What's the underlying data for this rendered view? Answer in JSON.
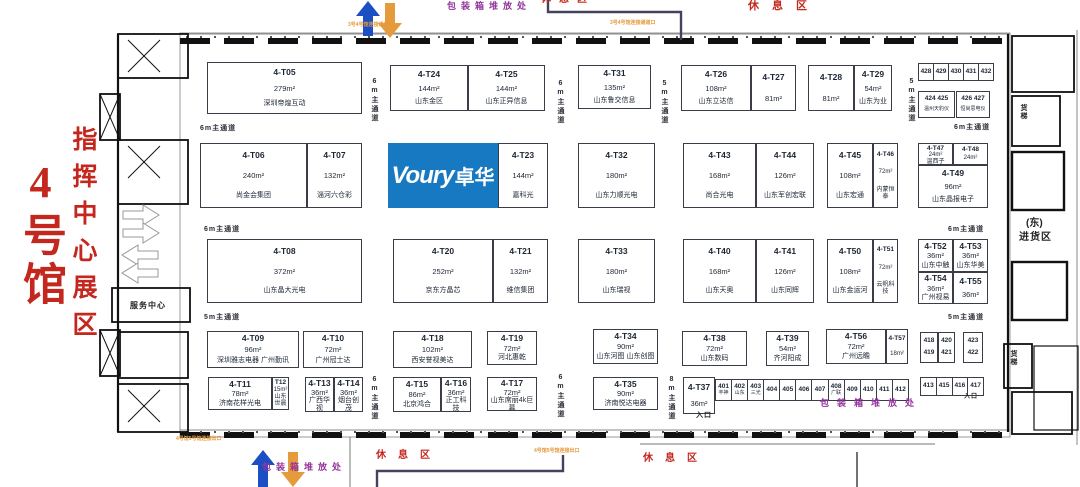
{
  "left": {
    "hall": "4号馆",
    "zone": "指挥中心展区",
    "service_center": "服务中心"
  },
  "logo": {
    "en": "Voury",
    "cn": "卓华"
  },
  "colors": {
    "red": "#c4271d",
    "orange": "#e59a3c",
    "blue": "#1d4fc4",
    "purple": "#94359c",
    "navy": "#43435f",
    "logo_blue": "#1779c1"
  },
  "booths": [
    {
      "id": "4-T05",
      "area": "279m²",
      "name": "深圳帝煌互动",
      "x": 207,
      "y": 62,
      "w": 155,
      "h": 52
    },
    {
      "id": "4-T24",
      "area": "144m²",
      "name": "山东金区",
      "x": 390,
      "y": 65,
      "w": 78,
      "h": 46
    },
    {
      "id": "4-T25",
      "area": "144m²",
      "name": "山东正异信息",
      "x": 468,
      "y": 65,
      "w": 77,
      "h": 46
    },
    {
      "id": "4-T31",
      "area": "135m²",
      "name": "山东鲁交信息",
      "x": 578,
      "y": 65,
      "w": 73,
      "h": 44
    },
    {
      "id": "4-T26",
      "area": "108m²",
      "name": "山东立达信",
      "x": 681,
      "y": 65,
      "w": 70,
      "h": 46
    },
    {
      "id": "4-T27",
      "area": "81m²",
      "name": "",
      "x": 751,
      "y": 65,
      "w": 45,
      "h": 46
    },
    {
      "id": "4-T28",
      "area": "81m²",
      "name": "",
      "x": 808,
      "y": 65,
      "w": 46,
      "h": 46
    },
    {
      "id": "4-T29",
      "area": "54m²",
      "name": "山东为业",
      "x": 854,
      "y": 65,
      "w": 38,
      "h": 46
    },
    {
      "id": "4-T06",
      "area": "240m²",
      "name": "尚金会集团",
      "x": 200,
      "y": 143,
      "w": 107,
      "h": 65
    },
    {
      "id": "4-T07",
      "area": "132m²",
      "name": "淄河六仓彩",
      "x": 307,
      "y": 143,
      "w": 55,
      "h": 65
    },
    {
      "id": "4-T23",
      "area": "144m²",
      "name": "嘉科光",
      "x": 498,
      "y": 143,
      "w": 50,
      "h": 65
    },
    {
      "id": "4-T32",
      "area": "180m²",
      "name": "山东力顺光电",
      "x": 578,
      "y": 143,
      "w": 77,
      "h": 65
    },
    {
      "id": "4-T43",
      "area": "168m²",
      "name": "尚合光电",
      "x": 683,
      "y": 143,
      "w": 73,
      "h": 65
    },
    {
      "id": "4-T44",
      "area": "126m²",
      "name": "山东军创宏联",
      "x": 756,
      "y": 143,
      "w": 58,
      "h": 65
    },
    {
      "id": "4-T45",
      "area": "108m²",
      "name": "山东宏通",
      "x": 827,
      "y": 143,
      "w": 46,
      "h": 65
    },
    {
      "id": "4-T46",
      "area": "72m²",
      "name": "内蒙恒泰",
      "x": 873,
      "y": 143,
      "w": 25,
      "h": 65
    },
    {
      "id": "4-T47",
      "area": "24m²",
      "name": "温西子",
      "x": 918,
      "y": 143,
      "w": 35,
      "h": 22
    },
    {
      "id": "4-T48",
      "area": "24m²",
      "name": "",
      "x": 953,
      "y": 143,
      "w": 35,
      "h": 22
    },
    {
      "id": "4-T49",
      "area": "96m²",
      "name": "山东晶报电子",
      "x": 918,
      "y": 165,
      "w": 70,
      "h": 43
    },
    {
      "id": "4-T08",
      "area": "372m²",
      "name": "山东晶大光电",
      "x": 207,
      "y": 239,
      "w": 155,
      "h": 64
    },
    {
      "id": "4-T20",
      "area": "252m²",
      "name": "京东方晶芯",
      "x": 393,
      "y": 239,
      "w": 100,
      "h": 64
    },
    {
      "id": "4-T21",
      "area": "132m²",
      "name": "维信集团",
      "x": 493,
      "y": 239,
      "w": 55,
      "h": 64
    },
    {
      "id": "4-T33",
      "area": "180m²",
      "name": "山东瑞视",
      "x": 578,
      "y": 239,
      "w": 77,
      "h": 64
    },
    {
      "id": "4-T40",
      "area": "168m²",
      "name": "山东天奥",
      "x": 683,
      "y": 239,
      "w": 73,
      "h": 64
    },
    {
      "id": "4-T41",
      "area": "126m²",
      "name": "山东同辉",
      "x": 756,
      "y": 239,
      "w": 58,
      "h": 64
    },
    {
      "id": "4-T50",
      "area": "108m²",
      "name": "山东金运河",
      "x": 827,
      "y": 239,
      "w": 46,
      "h": 64
    },
    {
      "id": "4-T51",
      "area": "72m²",
      "name": "云帆科技",
      "x": 873,
      "y": 239,
      "w": 25,
      "h": 64
    },
    {
      "id": "4-T52",
      "area": "36m²",
      "name": "山东中触",
      "x": 918,
      "y": 239,
      "w": 35,
      "h": 33
    },
    {
      "id": "4-T53",
      "area": "36m²",
      "name": "山东华美",
      "x": 953,
      "y": 239,
      "w": 35,
      "h": 33
    },
    {
      "id": "4-T54",
      "area": "36m²",
      "name": "广州视易",
      "x": 918,
      "y": 272,
      "w": 35,
      "h": 32
    },
    {
      "id": "4-T55",
      "area": "36m²",
      "name": "",
      "x": 953,
      "y": 272,
      "w": 35,
      "h": 32
    },
    {
      "id": "4-T09",
      "area": "96m²",
      "name": "深圳雅志电器 广州勤讯",
      "x": 207,
      "y": 331,
      "w": 92,
      "h": 37
    },
    {
      "id": "4-T10",
      "area": "72m²",
      "name": "广州冠士达",
      "x": 303,
      "y": 331,
      "w": 60,
      "h": 37
    },
    {
      "id": "4-T18",
      "area": "102m²",
      "name": "西安誉视美达",
      "x": 393,
      "y": 331,
      "w": 79,
      "h": 37
    },
    {
      "id": "4-T19",
      "area": "72m²",
      "name": "河北惠乾",
      "x": 487,
      "y": 331,
      "w": 50,
      "h": 34
    },
    {
      "id": "4-T34",
      "area": "90m²",
      "name": "山东河图 山东创图",
      "x": 593,
      "y": 329,
      "w": 65,
      "h": 35
    },
    {
      "id": "4-T38",
      "area": "72m²",
      "name": "山东数码",
      "x": 682,
      "y": 331,
      "w": 65,
      "h": 35
    },
    {
      "id": "4-T39",
      "area": "54m²",
      "name": "齐河阳成",
      "x": 766,
      "y": 331,
      "w": 43,
      "h": 35
    },
    {
      "id": "4-T56",
      "area": "72m²",
      "name": "广州远瞻",
      "x": 826,
      "y": 329,
      "w": 60,
      "h": 35
    },
    {
      "id": "4-T57",
      "area": "18m²",
      "name": "",
      "x": 886,
      "y": 329,
      "w": 22,
      "h": 35
    },
    {
      "id": "4-T11",
      "area": "78m²",
      "name": "济南花样光电",
      "x": 208,
      "y": 377,
      "w": 64,
      "h": 33
    },
    {
      "id": "T12",
      "area": "15m²",
      "name": "山东世晨",
      "x": 272,
      "y": 377,
      "w": 17,
      "h": 33
    },
    {
      "id": "4-T13",
      "area": "36m²",
      "name": "广西华视",
      "x": 305,
      "y": 377,
      "w": 29,
      "h": 35
    },
    {
      "id": "4-T14",
      "area": "36m²",
      "name": "烟台创茂",
      "x": 334,
      "y": 377,
      "w": 29,
      "h": 35
    },
    {
      "id": "4-T15",
      "area": "86m²",
      "name": "北京鸿合",
      "x": 393,
      "y": 377,
      "w": 48,
      "h": 35
    },
    {
      "id": "4-T16",
      "area": "36m²",
      "name": "正工科技",
      "x": 441,
      "y": 377,
      "w": 30,
      "h": 35
    },
    {
      "id": "4-T17",
      "area": "72m²",
      "name": "山东席丽4k巨幕",
      "x": 487,
      "y": 377,
      "w": 50,
      "h": 34
    },
    {
      "id": "4-T35",
      "area": "90m²",
      "name": "济南悦达电器",
      "x": 593,
      "y": 377,
      "w": 65,
      "h": 33
    },
    {
      "id": "4-T37",
      "area": "36m²",
      "name": "",
      "x": 683,
      "y": 377,
      "w": 32,
      "h": 37
    }
  ],
  "grids": [
    {
      "name": "booths-428-432",
      "x": 918,
      "y": 63,
      "w": 76,
      "h": 18,
      "cells": [
        "428",
        "429",
        "430",
        "431",
        "432"
      ]
    },
    {
      "name": "booths-424-425",
      "x": 918,
      "y": 91,
      "w": 37,
      "h": 27,
      "lines": [
        "424 425",
        "温州天豹仪"
      ]
    },
    {
      "name": "booths-426-427",
      "x": 956,
      "y": 91,
      "w": 34,
      "h": 27,
      "lines": [
        "426 427",
        "恒尚思电仪"
      ]
    },
    {
      "name": "booths-418-419",
      "x": 920,
      "y": 332,
      "w": 18,
      "h": 31,
      "lines": [
        "418",
        "419"
      ]
    },
    {
      "name": "booths-420-421",
      "x": 938,
      "y": 332,
      "w": 17,
      "h": 31,
      "lines": [
        "420",
        "421"
      ]
    },
    {
      "name": "booths-422-423",
      "x": 963,
      "y": 332,
      "w": 20,
      "h": 31,
      "lines": [
        "423",
        "422"
      ]
    },
    {
      "name": "booths-413-417",
      "x": 920,
      "y": 377,
      "w": 64,
      "h": 19,
      "cells": [
        "413",
        "415",
        "416",
        "417"
      ]
    },
    {
      "name": "booths-401-412",
      "x": 715,
      "y": 379,
      "w": 194,
      "h": 22,
      "cells": [
        "401",
        "402",
        "403",
        "404",
        "405",
        "406",
        "407",
        "408",
        "409",
        "410",
        "411",
        "412"
      ],
      "notes": {
        "401": "丰神",
        "402": "山东",
        "403": "三光",
        "408": "广联"
      }
    }
  ],
  "corridors": [
    {
      "t": "6m主通道",
      "x": 200,
      "y": 123,
      "v": false
    },
    {
      "t": "6m主通道",
      "x": 369,
      "y": 78,
      "v": true
    },
    {
      "t": "6m主通道",
      "x": 555,
      "y": 80,
      "v": true
    },
    {
      "t": "5m主通道",
      "x": 659,
      "y": 80,
      "v": true
    },
    {
      "t": "5m主通道",
      "x": 906,
      "y": 78,
      "v": true
    },
    {
      "t": "6m主通道",
      "x": 954,
      "y": 122,
      "v": false
    },
    {
      "t": "6m主通道",
      "x": 204,
      "y": 224,
      "v": false
    },
    {
      "t": "6m主通道",
      "x": 948,
      "y": 224,
      "v": false
    },
    {
      "t": "5m主通道",
      "x": 204,
      "y": 312,
      "v": false
    },
    {
      "t": "5m主通道",
      "x": 948,
      "y": 312,
      "v": false
    },
    {
      "t": "6m主通道",
      "x": 369,
      "y": 376,
      "v": true
    },
    {
      "t": "6m主通道",
      "x": 555,
      "y": 374,
      "v": true
    },
    {
      "t": "8m主通道",
      "x": 666,
      "y": 376,
      "v": true
    }
  ],
  "annotations": [
    {
      "t": "包装箱堆放处",
      "x": 447,
      "y": 2,
      "c": "purple",
      "s": 9,
      "sp": 5
    },
    {
      "t": "休息区",
      "x": 541,
      "y": -5,
      "c": "red",
      "s": 10,
      "sp": 8
    },
    {
      "t": "休息区",
      "x": 748,
      "y": 1,
      "c": "red",
      "s": 11,
      "sp": 13
    },
    {
      "t": "3号4号馆连接通道口",
      "x": 348,
      "y": 23,
      "c": "orange",
      "s": 5,
      "sp": 0
    },
    {
      "t": "3号4号馆连接通道口",
      "x": 610,
      "y": 21,
      "c": "orange",
      "s": 5,
      "sp": 0
    },
    {
      "t": "服务中心",
      "x": 130,
      "y": 302,
      "c": "black",
      "s": 8,
      "sp": 1
    },
    {
      "t": "货梯",
      "x": 1020,
      "y": 104,
      "c": "black",
      "s": 7,
      "sp": 1,
      "v": true
    },
    {
      "t": "货梯",
      "x": 1010,
      "y": 350,
      "c": "black",
      "s": 7,
      "sp": 1,
      "v": true
    },
    {
      "t": "(东)",
      "x": 1026,
      "y": 219,
      "c": "black",
      "s": 10,
      "sp": 0
    },
    {
      "t": "进货区",
      "x": 1019,
      "y": 233,
      "c": "black",
      "s": 10,
      "sp": 1
    },
    {
      "t": "入口",
      "x": 696,
      "y": 412,
      "c": "black",
      "s": 7,
      "sp": 1
    },
    {
      "t": "入口",
      "x": 964,
      "y": 394,
      "c": "black",
      "s": 6,
      "sp": 1
    },
    {
      "t": "包装箱堆放处",
      "x": 820,
      "y": 399,
      "c": "purple",
      "s": 9,
      "sp": 8
    },
    {
      "t": "包装箱堆放处",
      "x": 262,
      "y": 463,
      "c": "purple",
      "s": 9,
      "sp": 5
    },
    {
      "t": "休息区",
      "x": 376,
      "y": 451,
      "c": "red",
      "s": 10,
      "sp": 12
    },
    {
      "t": "休息区",
      "x": 643,
      "y": 454,
      "c": "red",
      "s": 10,
      "sp": 12
    },
    {
      "t": "4号馆5号馆连接出口",
      "x": 176,
      "y": 437,
      "c": "orange",
      "s": 5,
      "sp": 0
    },
    {
      "t": "4号馆5号馆连接出口",
      "x": 534,
      "y": 449,
      "c": "orange",
      "s": 5,
      "sp": 0
    }
  ]
}
